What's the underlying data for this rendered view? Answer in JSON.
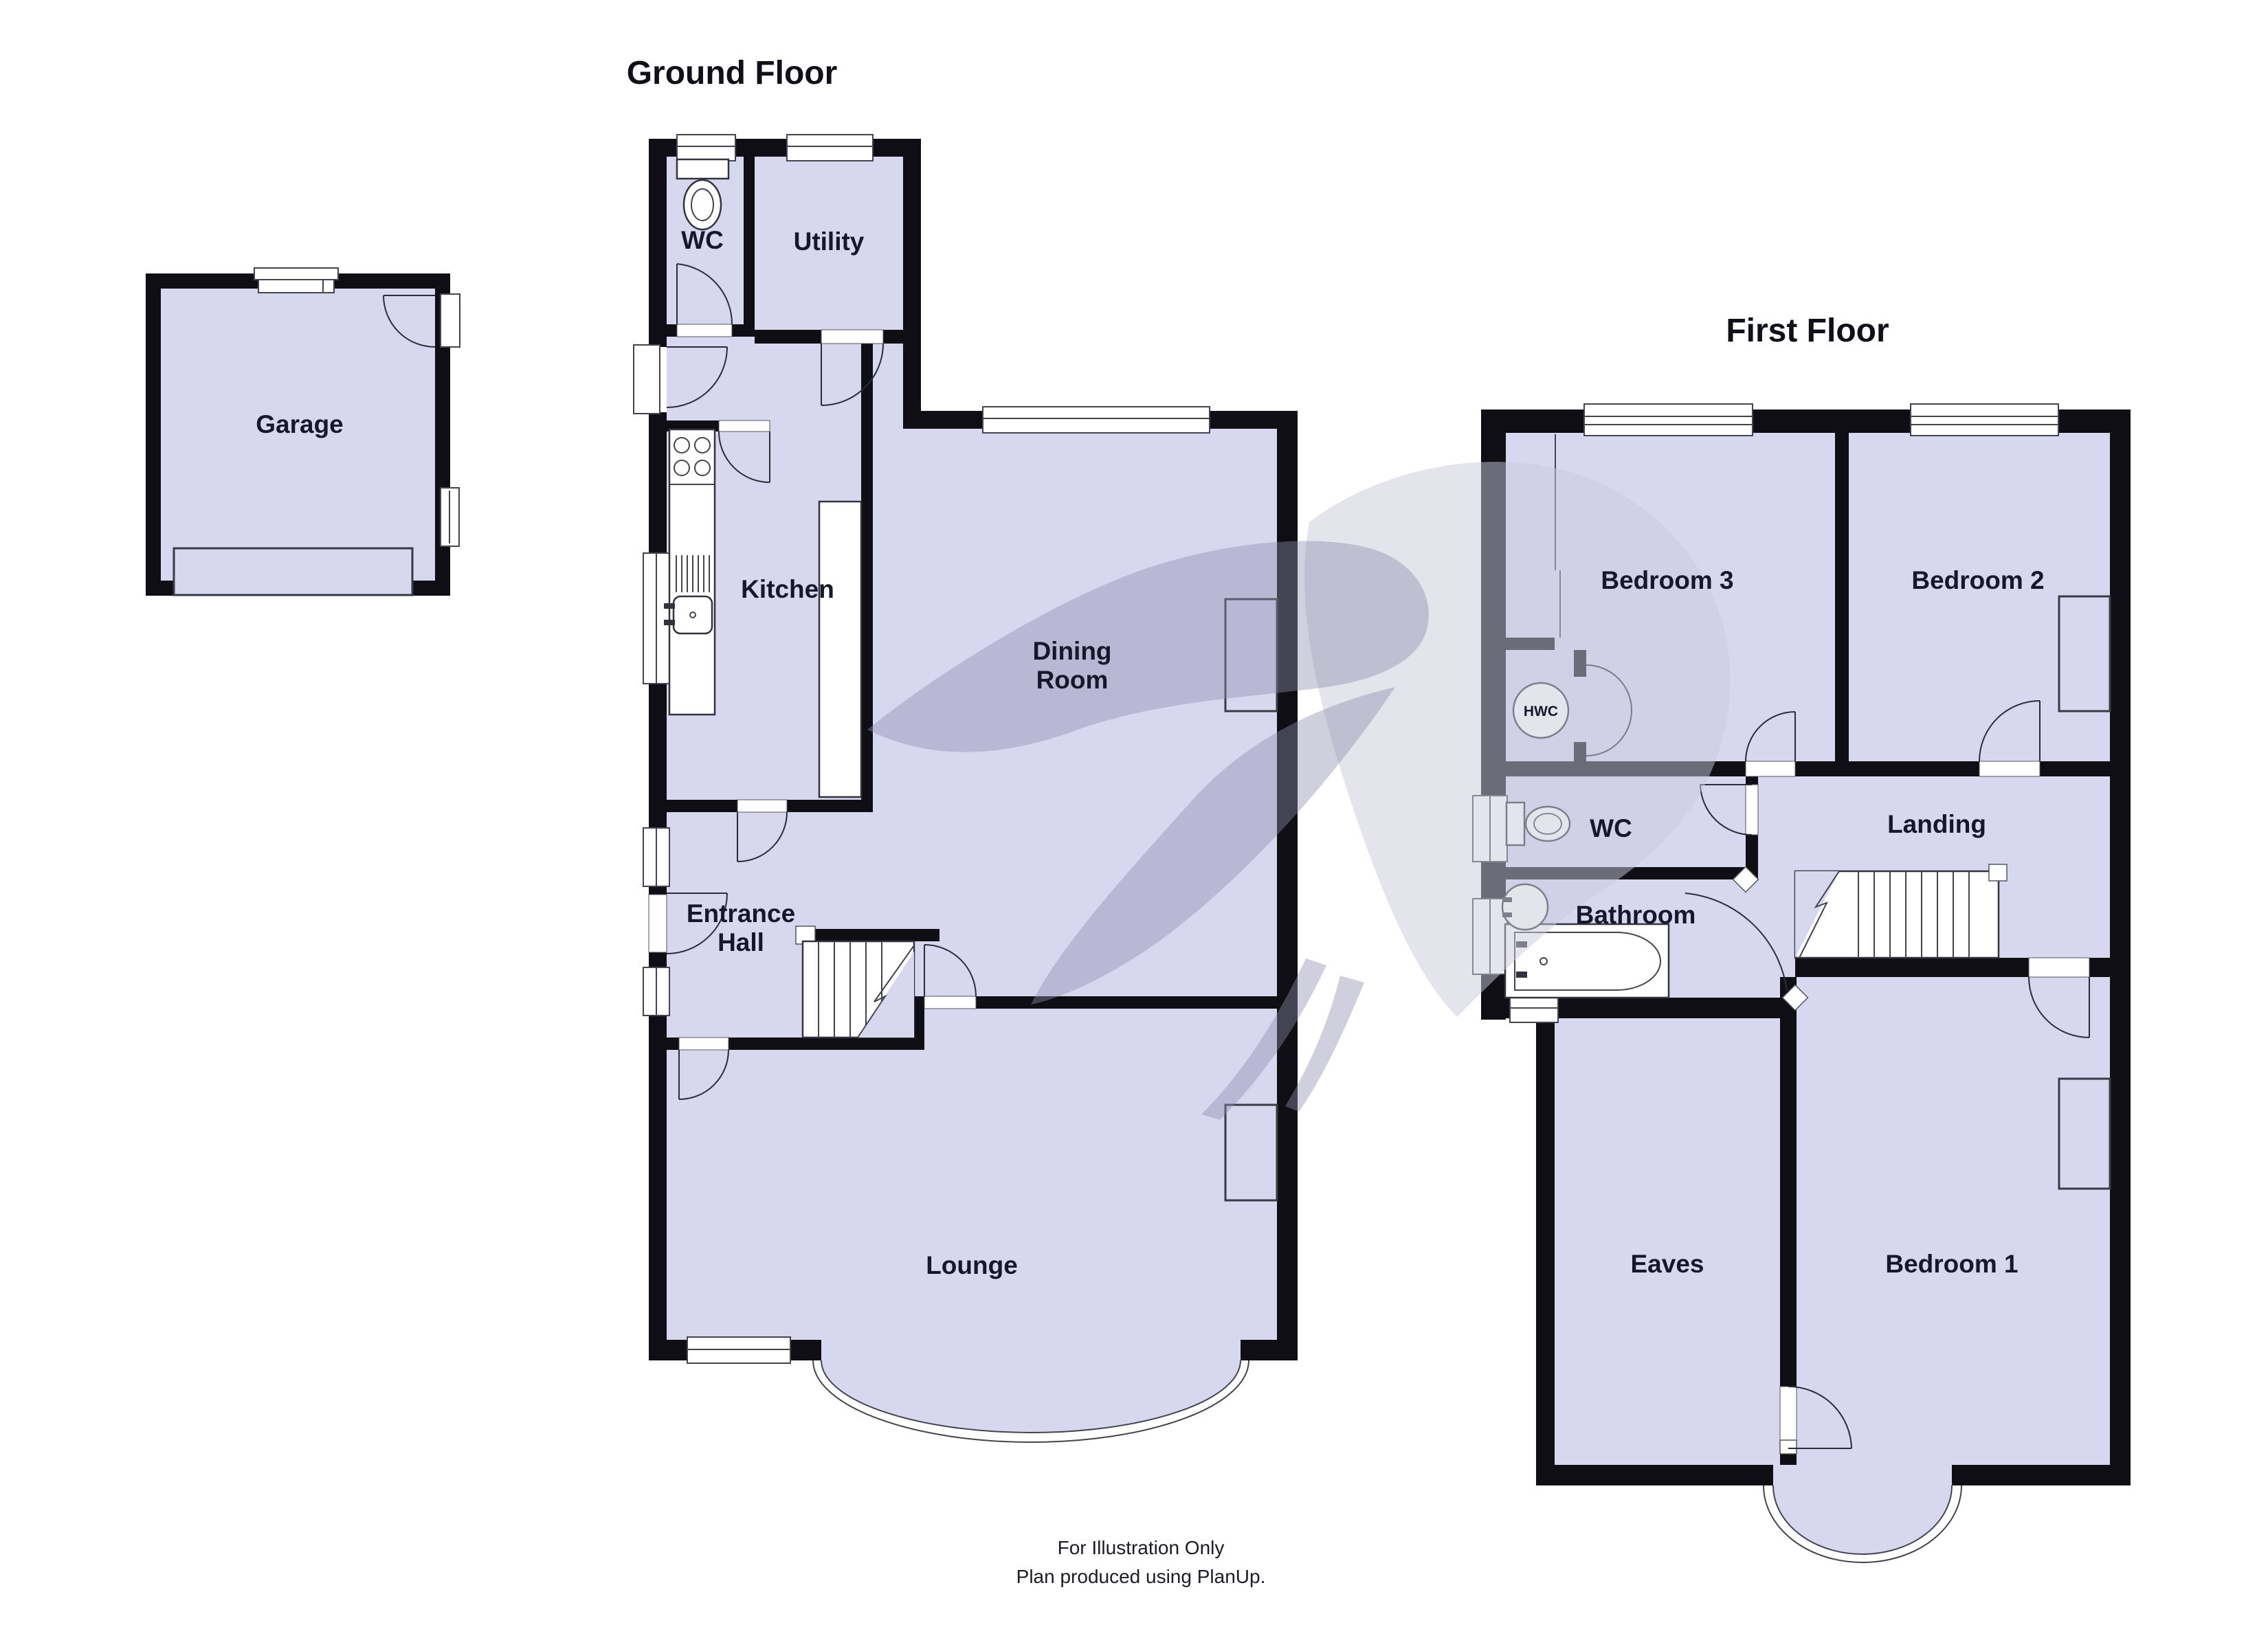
{
  "document": {
    "type": "floorplan",
    "footer": {
      "line1": "For Illustration Only",
      "line2": "Plan produced using PlanUp."
    }
  },
  "colors": {
    "room_fill": "#d7d7f0",
    "wall": "#0e0e14",
    "watermark_dark": "#8d8dad",
    "watermark_light": "#c9c9dc",
    "label_ink": "#17172c"
  },
  "ground_floor": {
    "title": "Ground Floor",
    "rooms": {
      "garage": "Garage",
      "wc": "WC",
      "utility": "Utility",
      "kitchen": "Kitchen",
      "dining_line1": "Dining",
      "dining_line2": "Room",
      "hall_line1": "Entrance",
      "hall_line2": "Hall",
      "lounge": "Lounge"
    }
  },
  "first_floor": {
    "title": "First Floor",
    "rooms": {
      "bedroom3": "Bedroom 3",
      "bedroom2": "Bedroom 2",
      "wc": "WC",
      "bathroom": "Bathroom",
      "landing": "Landing",
      "eaves": "Eaves",
      "bedroom1": "Bedroom 1"
    },
    "fixtures": {
      "hwc": "HWC"
    }
  }
}
